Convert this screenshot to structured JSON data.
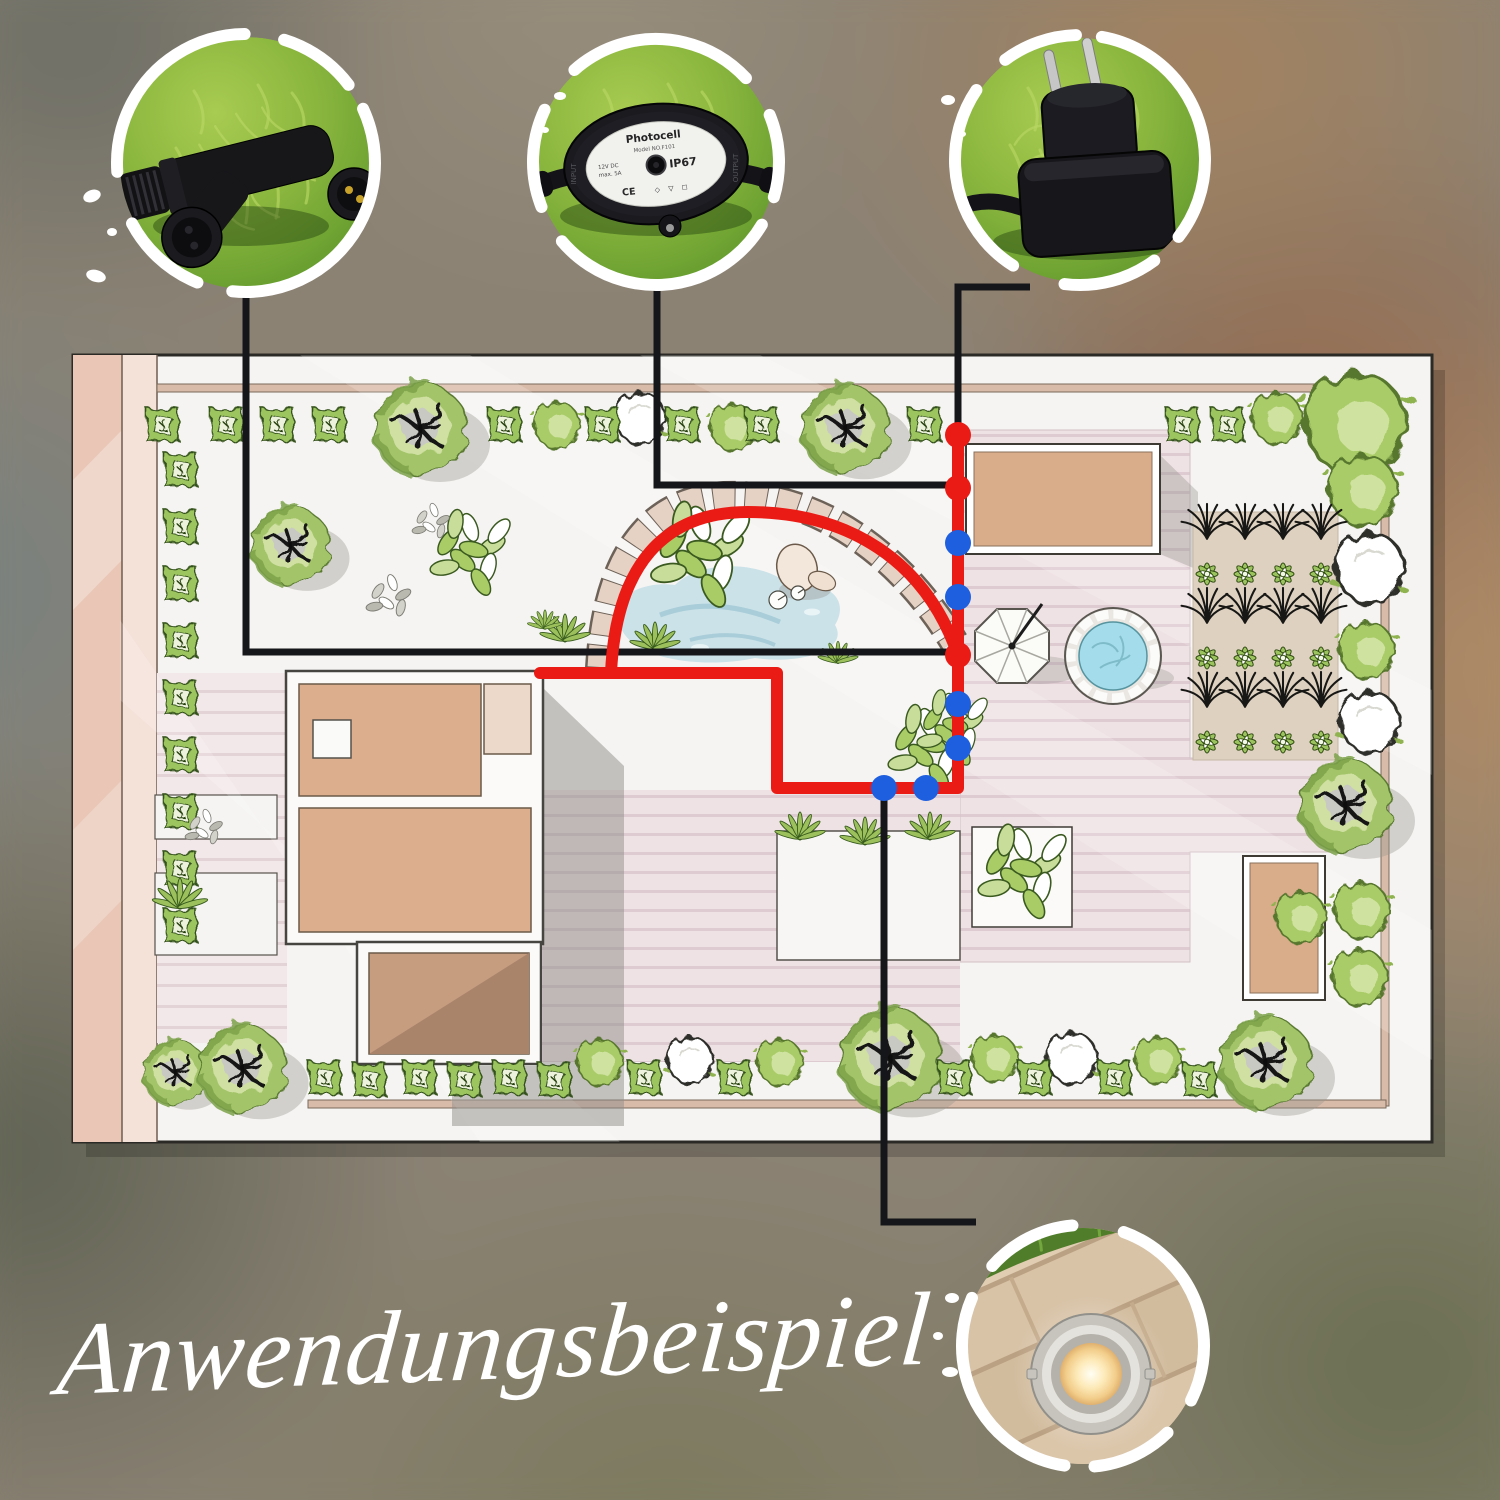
{
  "title": "Anwendungsbeispiel",
  "colors": {
    "cable_route": "#ea1b14",
    "junction_dot": "#ea1b14",
    "light_dot": "#1e5fe0",
    "connector_line": "#15161a",
    "plan_background": "#f6f4f2",
    "plan_wall": "#eccaba",
    "deck": "#efe2e4",
    "pond_water": "#cbe2e8",
    "stone_path": "#e6d2c4",
    "house_room": "#dcae8e",
    "foliage_green": "#a9cc67",
    "title_color": "#ffffff"
  },
  "callouts": [
    {
      "id": "t-connector",
      "product": "T-connector"
    },
    {
      "id": "photocell",
      "product": "Photocell",
      "label": {
        "title": "Photocell",
        "model": "Model NO.F101",
        "spec1": "12V DC",
        "spec2": "max. 5A",
        "rating": "IP67",
        "input": "INPUT",
        "output": "OUTPUT",
        "ce": "CE",
        "marks": "◇ ▽ ◻"
      }
    },
    {
      "id": "power-plug",
      "product": "Power plug"
    },
    {
      "id": "ground-light",
      "product": "Recessed ground light"
    }
  ],
  "diagram": {
    "route_main": "M958,433 L958,788 L777,788 L777,673 L540,673",
    "route_arc": "M958,655 C925,560 848,512 748,512 C664,512 616,565 611,673",
    "connectors": [
      "M246,289 L246,652 L951,652",
      "M657,282 L657,485 L951,485",
      "M1030,287 L958,287 L958,430",
      "M884,794 L884,1222 L976,1222"
    ],
    "junction_points": [
      [
        958,
        435
      ],
      [
        958,
        488
      ],
      [
        958,
        655
      ]
    ],
    "light_points": [
      [
        958,
        543
      ],
      [
        958,
        597
      ],
      [
        958,
        704
      ],
      [
        958,
        748
      ],
      [
        884,
        788
      ],
      [
        926,
        788
      ]
    ]
  }
}
